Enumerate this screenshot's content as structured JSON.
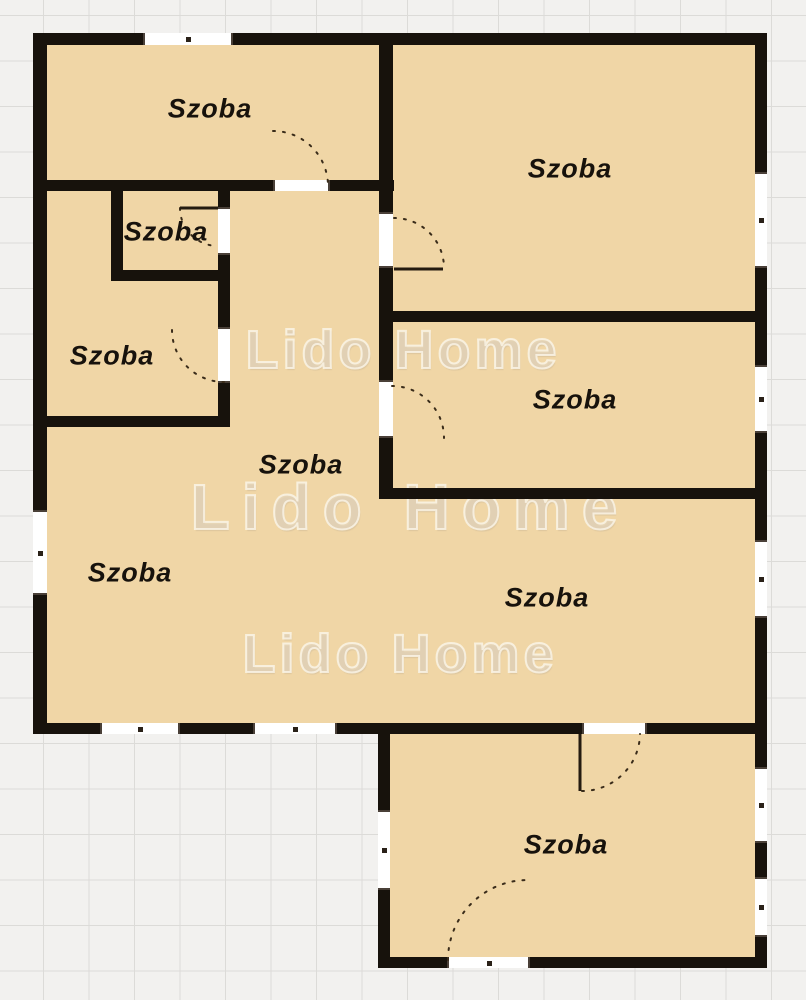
{
  "plan": {
    "type": "floor-plan",
    "agency_watermark": "Lido Home"
  },
  "watermarks": [
    {
      "text": "Lido Home"
    },
    {
      "text": "Lido Home"
    },
    {
      "text": "Lido Home"
    }
  ],
  "rooms": [
    {
      "id": "room-top-left",
      "label": "Szoba"
    },
    {
      "id": "room-top-right",
      "label": "Szoba"
    },
    {
      "id": "room-small",
      "label": "Szoba"
    },
    {
      "id": "room-left-middle",
      "label": "Szoba"
    },
    {
      "id": "room-middle-right",
      "label": "Szoba"
    },
    {
      "id": "room-hall",
      "label": "Szoba"
    },
    {
      "id": "room-left-bottom",
      "label": "Szoba"
    },
    {
      "id": "room-bottom-center",
      "label": "Szoba"
    },
    {
      "id": "room-bottom",
      "label": "Szoba"
    }
  ],
  "colors": {
    "floor": "#F0D6A6",
    "wall": "#17120C",
    "background": "#F2F1EF",
    "grid_line": "#DCDBD8",
    "label_text": "#17120C",
    "watermark": "#E4D9C6"
  }
}
